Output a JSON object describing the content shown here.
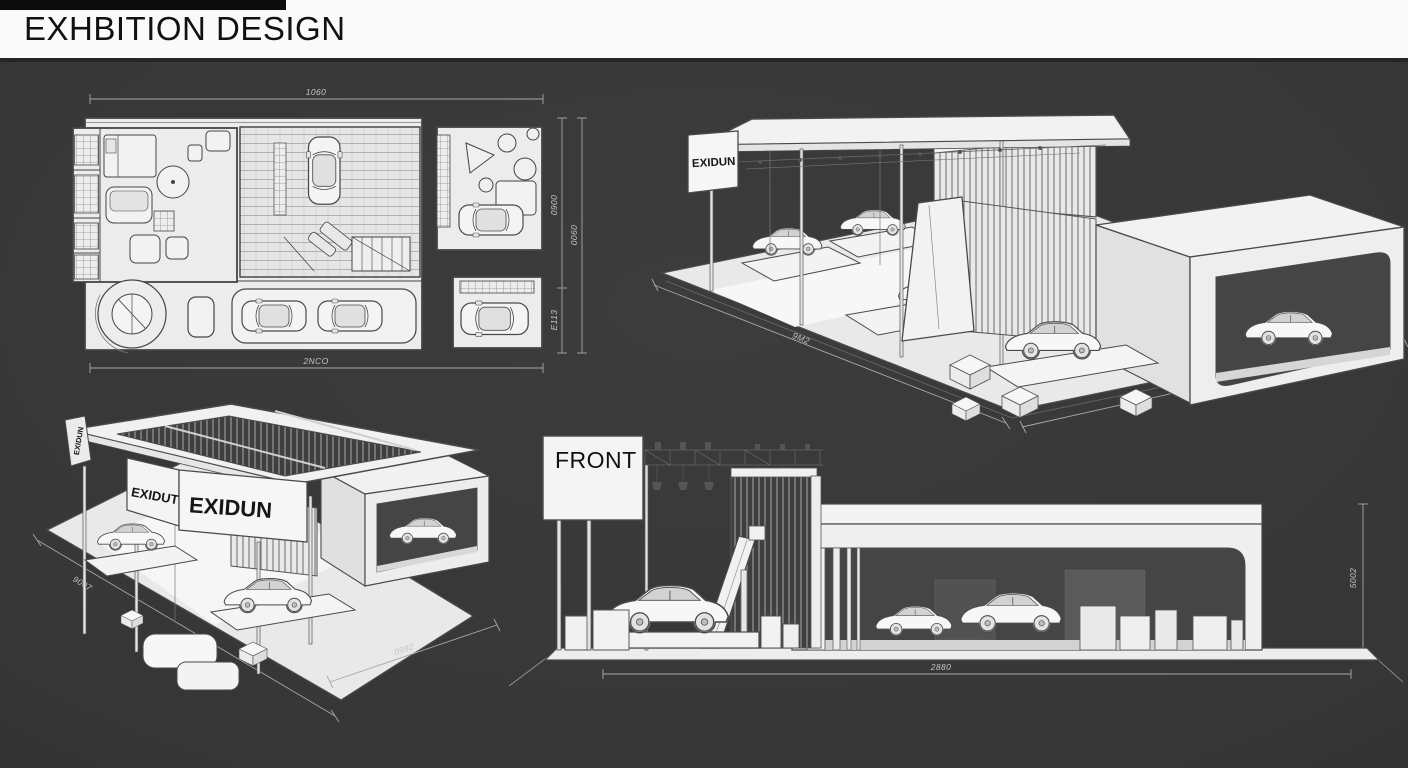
{
  "header": {
    "title": "EXHBITION DESIGN"
  },
  "colors": {
    "background": "#373737",
    "top_accent_bar": "#0c0c0c",
    "header_bg": "#fafafa",
    "header_text": "#111111",
    "drawing_paper": "#ececec",
    "drawing_line": "#4a4a4a",
    "dimension_line": "#a8a8a8",
    "dimension_text": "#c4c4c4"
  },
  "views": {
    "floor_plan": {
      "dim_top": "1060",
      "dim_bottom": "2NCO",
      "dim_right_upper": "0900",
      "dim_right_lower": "E113",
      "dim_right_outer": "0060"
    },
    "iso_right": {
      "sign": "EXIDUN",
      "dim_left": "9M2",
      "dim_right": "1007"
    },
    "iso_left": {
      "sign_small": "EXIDUN",
      "sign_side": "EXIDUT",
      "sign_front": "EXIDUN",
      "dim_left": "9007",
      "dim_bottom": "0992"
    },
    "front": {
      "label": "FRONT",
      "dim_bottom": "2880",
      "dim_right": "5002"
    }
  }
}
